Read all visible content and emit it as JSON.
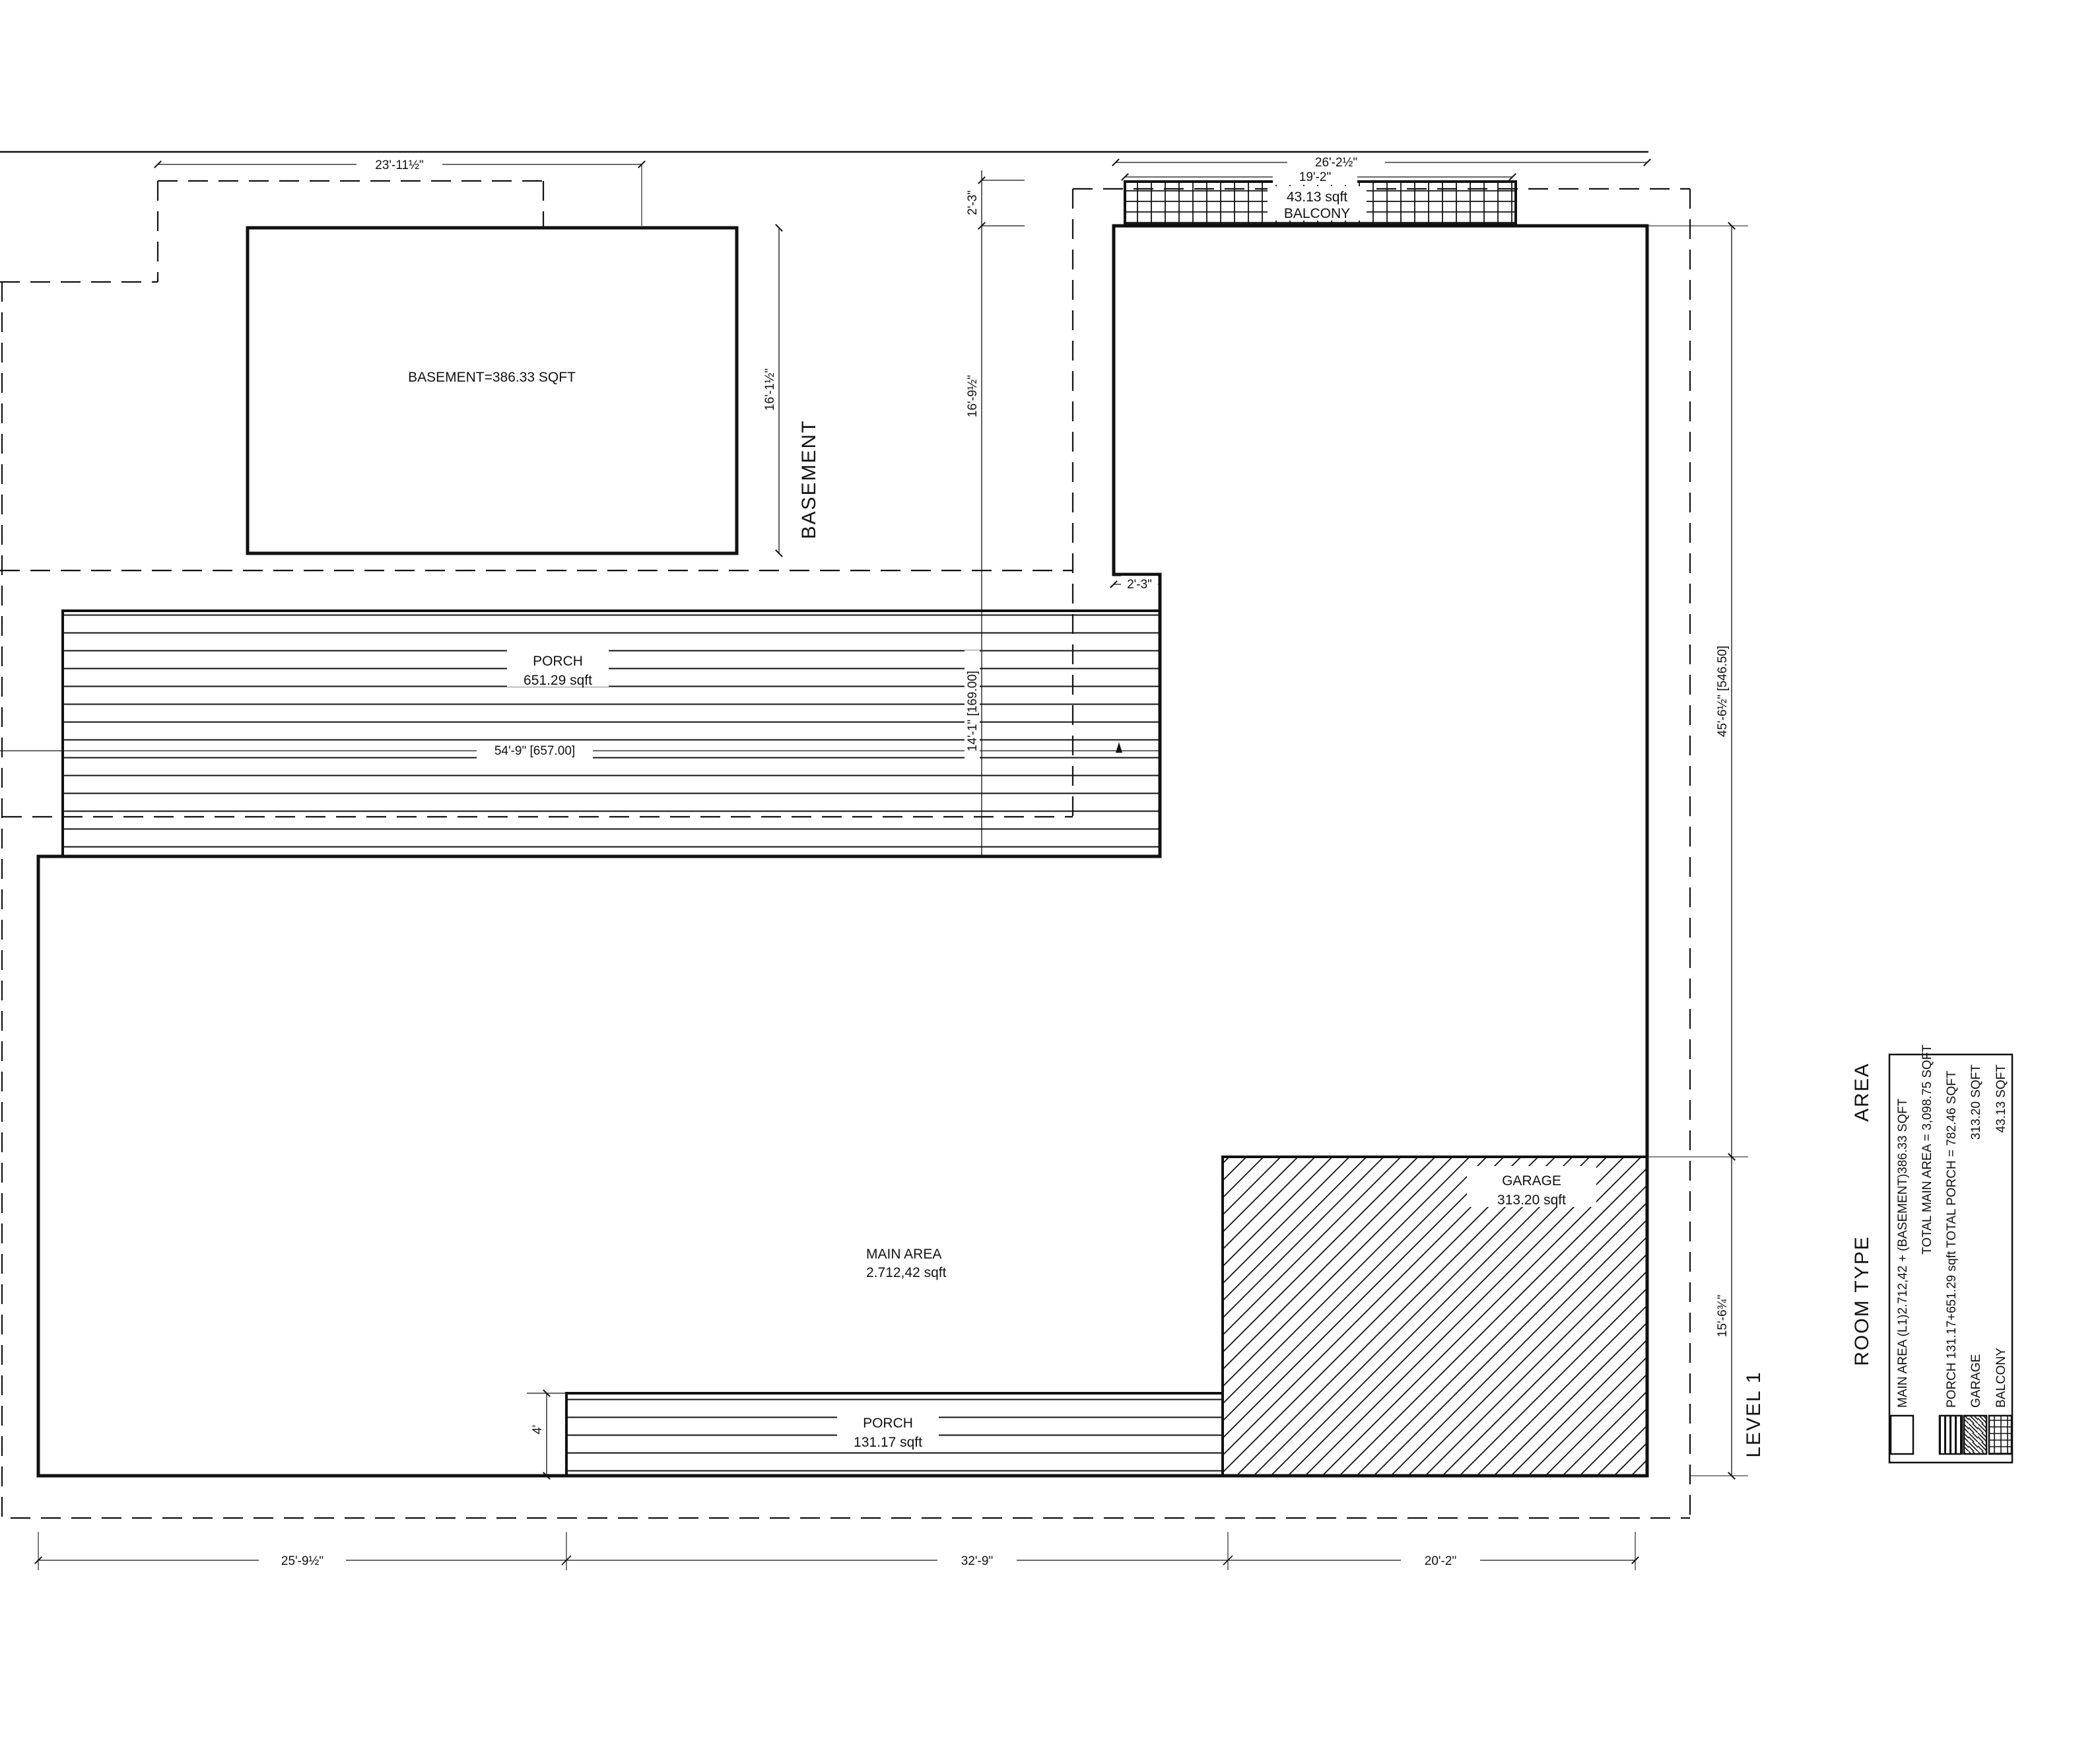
{
  "drawing": {
    "basement": {
      "section_title": "BASEMENT",
      "room_label": "BASEMENT=386.33 SQFT",
      "dim_width": "23'-11½\"",
      "dim_height": "16'-1½\""
    },
    "level1": {
      "section_title": "LEVEL 1",
      "main_area": {
        "name": "MAIN AREA",
        "area": "2.712,42 sqft"
      },
      "porch_upper": {
        "name": "PORCH",
        "area": "651.29 sqft",
        "dim_length": "54'-9\" [657.00]",
        "dim_depth": "14'-1\" [169.00]"
      },
      "porch_lower": {
        "name": "PORCH",
        "area": "131.17 sqft",
        "dim_depth": "4'"
      },
      "garage": {
        "name": "GARAGE",
        "area": "313.20 sqft"
      },
      "balcony": {
        "name": "BALCONY",
        "area": "43.13 sqft",
        "dim_outer": "26'-2½\"",
        "dim_width": "19'-2\""
      },
      "dims": {
        "step_top": "2'-3\"",
        "upper_wall": "16'-9½\"",
        "step_mid": "2'-3\"",
        "right_upper": "45'-6½\" [546.50]",
        "right_lower": "15'-6¾\"",
        "bottom_left": "25'-9½\"",
        "bottom_mid": "32'-9\"",
        "bottom_right": "20'-2\""
      }
    },
    "legend": {
      "header_room_type": "ROOM TYPE",
      "header_area": "AREA",
      "rows": [
        {
          "text": "MAIN AREA (L1)2.712,42 + (BASEMENT)386.33 SQFT"
        },
        {
          "text": "TOTAL MAIN AREA = 3,098.75 SQFT"
        },
        {
          "text": "PORCH 131.17+651.29 sqft TOTAL PORCH = 782.46 SQFT"
        },
        {
          "text": "GARAGE",
          "value": "313.20 SQFT"
        },
        {
          "text": "BALCONY",
          "value": "43.13 SQFT"
        }
      ]
    },
    "colors": {
      "line": "#111111",
      "background": "#ffffff"
    }
  }
}
